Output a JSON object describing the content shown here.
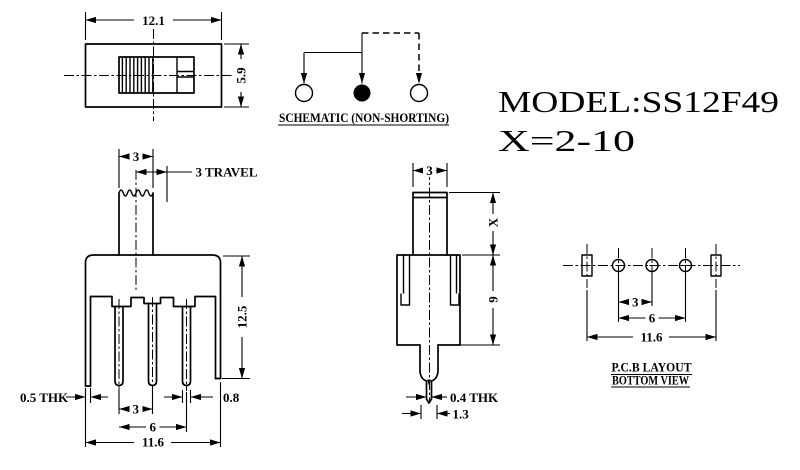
{
  "colors": {
    "ink": "#000000",
    "background": "#ffffff"
  },
  "title": {
    "model": "MODEL:SS12F49",
    "x_range": "X=2-10"
  },
  "schematic": {
    "caption": "SCHEMATIC (NON-SHORTING)"
  },
  "top_view": {
    "dim_width": "12.1",
    "dim_height": "5.9"
  },
  "front_view": {
    "dim_knob_width": "3",
    "dim_travel": "3 TRAVEL",
    "dim_height": "12.5",
    "dim_tab_thickness": "0.5 THK",
    "dim_pin_pitch": "3",
    "dim_pin_span": "6",
    "dim_overall_width": "11.6",
    "dim_pin_width": "0.8"
  },
  "side_view": {
    "dim_knob_depth": "3",
    "dim_actuator_height": "X",
    "dim_body_height": "9",
    "dim_pin_thickness": "0.4 THK",
    "dim_pin_base_width": "1.3"
  },
  "pcb_layout": {
    "dim_pitch": "3",
    "dim_span": "6",
    "dim_overall": "11.6",
    "caption_line1": "P.C.B LAYOUT",
    "caption_line2": "BOTTOM VIEW"
  }
}
